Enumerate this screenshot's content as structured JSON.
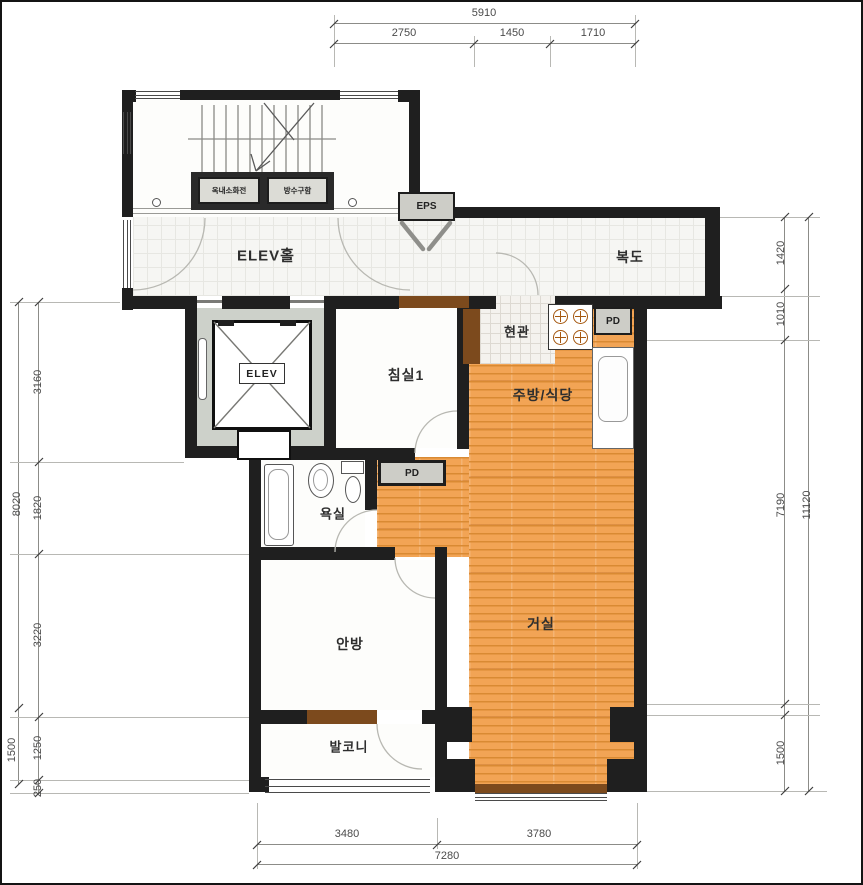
{
  "plan": {
    "rooms": {
      "elev_hall": "ELEV홀",
      "corridor": "복도",
      "eps": "EPS",
      "entrance": "현관",
      "bedroom1": "침실1",
      "kitchen_dining": "주방/식당",
      "elevator": "ELEV",
      "bathroom": "욕실",
      "pd_top": "PD",
      "pd_mid": "PD",
      "master_bedroom": "안방",
      "living_room": "거실",
      "balcony": "발코니",
      "hydrant_box": "옥내소화전",
      "hose_box": "방수구함"
    },
    "dimensions": {
      "top": {
        "total": "5910",
        "segments": [
          "2750",
          "1450",
          "1710"
        ]
      },
      "bottom": {
        "segments": [
          "3480",
          "3780"
        ],
        "total": "7280"
      },
      "left": {
        "inner": [
          "3160",
          "1820",
          "3220",
          "1250",
          "250"
        ],
        "outer": [
          "8020",
          "1500"
        ]
      },
      "right": {
        "inner": [
          "1420",
          "1010",
          "7190",
          "1500"
        ],
        "outer": "11120"
      }
    },
    "colors": {
      "wall": "#1f1f1f",
      "wood_floor": "#f2a455",
      "wood_stripe": "#d98a33",
      "door_brown": "#7c4a1d",
      "box_grey": "#cdcdc7",
      "shaft_grey": "#cdd1ca",
      "dim_text": "#4a4a4a"
    }
  }
}
